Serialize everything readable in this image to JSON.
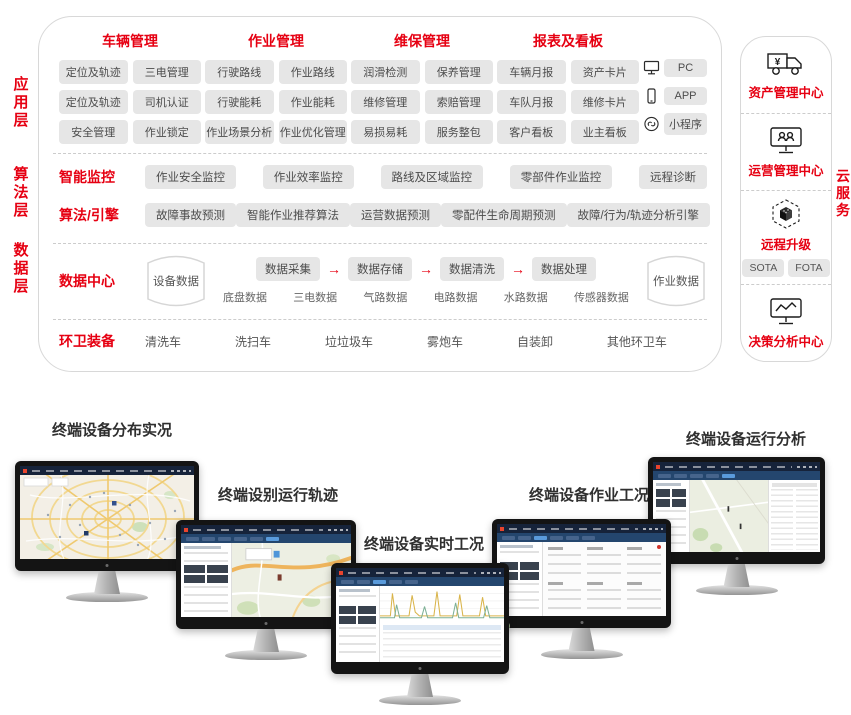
{
  "colors": {
    "accent": "#e60012",
    "pill_bg": "#e6e6e6",
    "pill_text": "#4c4c4c",
    "box_border": "#d8d8d8"
  },
  "architecture": {
    "layer_labels": [
      "应用层",
      "算法层",
      "数据层"
    ],
    "application": {
      "groups": [
        {
          "title": "车辆管理",
          "pills": [
            "定位及轨迹",
            "三电管理",
            "定位及轨迹",
            "司机认证",
            "安全管理",
            "作业锁定"
          ]
        },
        {
          "title": "作业管理",
          "pills": [
            "行驶路线",
            "作业路线",
            "行驶能耗",
            "作业能耗",
            "作业场景分析",
            "作业优化管理"
          ]
        },
        {
          "title": "维保管理",
          "pills": [
            "润滑检测",
            "保养管理",
            "维修管理",
            "索赔管理",
            "易损易耗",
            "服务整包"
          ]
        },
        {
          "title": "报表及看板",
          "pills": [
            "车辆月报",
            "资产卡片",
            "车队月报",
            "维修卡片",
            "客户看板",
            "业主看板"
          ]
        }
      ],
      "terminals": [
        {
          "icon": "pc-icon",
          "label": "PC"
        },
        {
          "icon": "smartphone-icon",
          "label": "APP"
        },
        {
          "icon": "miniprogram-link-icon",
          "label": "小程序"
        }
      ]
    },
    "monitoring_row": {
      "label": "智能监控",
      "pills": [
        "作业安全监控",
        "作业效率监控",
        "路线及区域监控",
        "零部件作业监控",
        "远程诊断"
      ]
    },
    "algorithm_row": {
      "label": "算法/引擎",
      "pills": [
        "故障事故预测",
        "智能作业推荐算法",
        "运营数据预测",
        "零配件生命周期预测",
        "故障/行为/轨迹分析引擎"
      ]
    },
    "data_center": {
      "label": "数据中心",
      "device_db": "设备数据",
      "pipeline": [
        "数据采集",
        "数据存储",
        "数据清洗",
        "数据处理"
      ],
      "arrow": "→",
      "sub_labels": [
        "底盘数据",
        "三电数据",
        "气路数据",
        "电路数据",
        "水路数据",
        "传感器数据"
      ],
      "work_db": "作业数据"
    },
    "equipment": {
      "label": "环卫装备",
      "items": [
        "清洗车",
        "洗扫车",
        "垃垃圾车",
        "雾炮车",
        "自装卸",
        "其他环卫车"
      ]
    }
  },
  "cloud_panel": {
    "side_label": "云服务",
    "items": [
      {
        "icon": "yen-truck-icon",
        "label": "资产管理中心"
      },
      {
        "icon": "monitor-users-icon",
        "label": "运营管理中心"
      },
      {
        "icon": "ota-cube-icon",
        "label": "远程升级",
        "tags": [
          "SOTA",
          "FOTA"
        ]
      },
      {
        "icon": "monitor-chart-icon",
        "label": "决策分析中心"
      }
    ]
  },
  "monitors": [
    {
      "caption": "终端设备分布实况"
    },
    {
      "caption": "终端设别运行轨迹"
    },
    {
      "caption": "终端设备实时工况"
    },
    {
      "caption": "终端设备作业工况"
    },
    {
      "caption": "终端设备运行分析"
    }
  ]
}
